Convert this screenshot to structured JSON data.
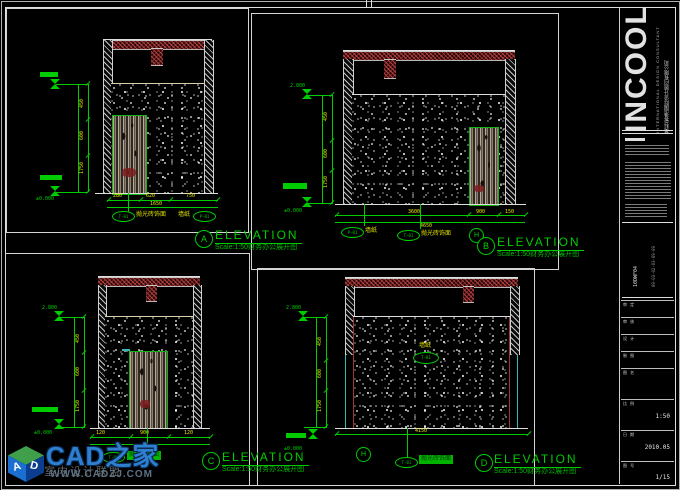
{
  "watermark": {
    "brand": "CAD之家",
    "tagline": "室内设计联盟",
    "url": "WWW.CADZJ.COM",
    "cube_front": "A",
    "cube_side": "D"
  },
  "titleblock": {
    "logo": "INCOOL",
    "logo_sub": "INTERNATIONAL DESIGN CONSULTANT",
    "company": "英科(香港)国际设计顾问有限公司",
    "project_code": "10DWF04",
    "index_code": "09-03-02-03-09-09",
    "rows": [
      {
        "label": "审 定",
        "value": ""
      },
      {
        "label": "审 核",
        "value": ""
      },
      {
        "label": "设 计",
        "value": ""
      },
      {
        "label": "制 图",
        "value": ""
      },
      {
        "label": "图 名",
        "value": ""
      },
      {
        "label": "比 例",
        "value": "1:50"
      },
      {
        "label": "日 期",
        "value": "2010.05"
      },
      {
        "label": "图 号",
        "value": "1/15"
      }
    ]
  },
  "colors": {
    "dim_green": "#00cc00",
    "dim_yellow": "#e6e600",
    "hatch_red": "#a03535",
    "watermark_blue": "#2e7fd0"
  },
  "elevations": {
    "A": {
      "letter": "A",
      "title": "ELEVATION",
      "scale": "Scale:1:50财务办公展开图",
      "level_bottom": "±0.000",
      "dl1": "450",
      "dl2": "600",
      "dl3": "1750",
      "db1": "280",
      "db2": "620",
      "db3": "750",
      "dbt": "1650",
      "t1": "T-01",
      "t1l": "抛光砖饰面",
      "t2": "P-01",
      "t2l": "墙纸"
    },
    "B": {
      "letter": "B",
      "title": "ELEVATION",
      "scale": "Scale:1:50财务办公展开图",
      "level_top": "2.800",
      "level_bottom": "±0.000",
      "dl1": "450",
      "dl2": "600",
      "dl3": "1750",
      "db1": "3600",
      "db2": "900",
      "db3": "150",
      "dbt": "4650",
      "t1": "P-01",
      "t1l": "墙纸",
      "t2": "T-01",
      "t2l": "抛光砖饰面",
      "axis": "H"
    },
    "C": {
      "letter": "C",
      "title": "ELEVATION",
      "scale": "Scale:1:50财务办公展开图",
      "level_top": "2.800",
      "level_bottom": "±0.000",
      "dl1": "450",
      "dl2": "600",
      "dl3": "1750",
      "db1": "120",
      "db2": "900",
      "db3": "120",
      "dbt": "1140",
      "t1": "T-01",
      "t1l": "抛光砖饰面"
    },
    "D": {
      "letter": "D",
      "title": "ELEVATION",
      "scale": "Scale:1:50财务办公展开图",
      "level_top": "2.800",
      "level_bottom": "±0.000",
      "dl1": "450",
      "dl2": "600",
      "dl3": "1750",
      "db1": "4150",
      "t1": "T-01",
      "t1l": "抛光砖饰面",
      "axis": "H",
      "center_label": "墙纸",
      "center_tag": "T-01"
    }
  }
}
